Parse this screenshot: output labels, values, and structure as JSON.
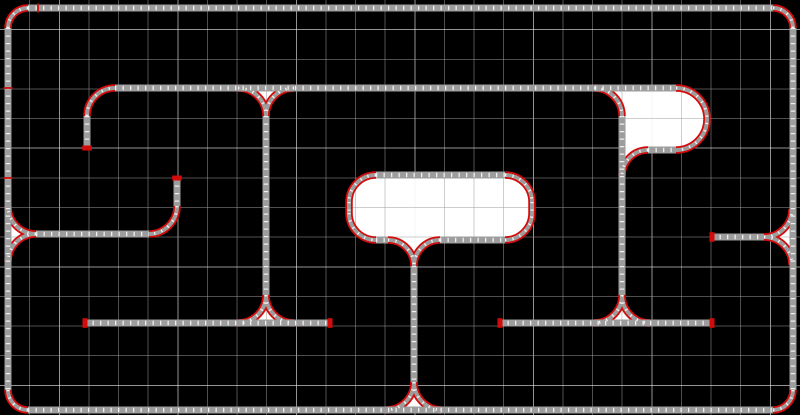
{
  "canvas": {
    "width": 800,
    "height": 415,
    "background": "#000000",
    "description": "track layout editor canvas"
  },
  "grid": {
    "cols": 27,
    "rows": 14,
    "minor_color": "rgba(158,158,158,0.5)",
    "major_color": "rgba(238,238,238,0.62)",
    "major_every": 4,
    "major_col_start": 2,
    "major_row_start": 1
  },
  "palette": {
    "track_gray": "#9d9d9d",
    "curve_red": "#d40b0b",
    "tie_white": "#f2f2f2",
    "region_fill": "#ffffff"
  },
  "regions": [
    {
      "name": "center-loop-area",
      "d": "M376,175 H505 A27,27 0 0 1 532,202 V213 A27,27 0 0 1 505,240 H440 A26,26 0 0 0 414,266 A26,26 0 0 0 388,240 H376 A27,27 0 0 1 349,213 V202 A27,27 0 0 1 376,175 Z"
    },
    {
      "name": "right-ploop-area",
      "d": "M594,88 H676 A31,31 0 1 1 676,150 H648 A26,26 0 0 0 622,176 V116 A28,28 0 0 0 594,88 Z"
    },
    {
      "name": "wye1-triangle",
      "d": "M238,88 A28,28 0 0 1 266,116 A28,28 0 0 1 294,88 Z"
    },
    {
      "name": "wye2-triangle",
      "d": "M238,323 A28,28 0 0 0 266,295 A28,28 0 0 0 294,323 Z"
    },
    {
      "name": "wye3-triangle",
      "d": "M8,206 A28,28 0 0 0 36,234 A28,28 0 0 0 8,262 Z"
    },
    {
      "name": "wye4-triangle",
      "d": "M792,209 A28,28 0 0 1 764,237 A28,28 0 0 1 792,265 Z"
    },
    {
      "name": "wye5-triangle",
      "d": "M386,410 A28,28 0 0 0 414,382 A28,28 0 0 0 442,410 Z"
    },
    {
      "name": "wye6-triangle",
      "d": "M594,323 A28,28 0 0 0 622,295 A28,28 0 0 0 650,323 Z"
    }
  ],
  "tracks": [
    {
      "name": "outer-top",
      "kind": "straight",
      "d": "M28,8 H773"
    },
    {
      "name": "outer-bottom",
      "kind": "straight",
      "d": "M28,410 H773"
    },
    {
      "name": "outer-left",
      "kind": "straight",
      "d": "M8,28 V390"
    },
    {
      "name": "outer-right",
      "kind": "straight",
      "d": "M793,28 V390"
    },
    {
      "name": "corner-top-left",
      "kind": "curve",
      "d": "M28,8 A20,20 0 0 0 8,28"
    },
    {
      "name": "corner-top-right",
      "kind": "curve",
      "d": "M773,8 A20,20 0 0 1 793,28"
    },
    {
      "name": "corner-bottom-left",
      "kind": "curve",
      "d": "M8,390 A20,20 0 0 0 28,410"
    },
    {
      "name": "corner-bottom-right",
      "kind": "curve",
      "d": "M773,410 A20,20 0 0 0 793,390"
    },
    {
      "name": "main-horizontal",
      "kind": "straight",
      "d": "M115,88 H676"
    },
    {
      "name": "spur-a-curve",
      "kind": "curve",
      "d": "M87,116 A28,28 0 0 1 115,88"
    },
    {
      "name": "spur-a-stub",
      "kind": "straight",
      "d": "M87,116 V148"
    },
    {
      "name": "wye1-west-arc",
      "kind": "curve",
      "d": "M238,88 A28,28 0 0 1 266,116"
    },
    {
      "name": "wye1-east-arc",
      "kind": "curve",
      "d": "M294,88 A28,28 0 0 0 266,116"
    },
    {
      "name": "center-vertical",
      "kind": "straight",
      "d": "M266,116 V295"
    },
    {
      "name": "wye2-west-arc",
      "kind": "curve",
      "d": "M266,295 A28,28 0 0 1 238,323"
    },
    {
      "name": "wye2-east-arc",
      "kind": "curve",
      "d": "M266,295 A28,28 0 0 0 294,323"
    },
    {
      "name": "siding-left",
      "kind": "straight",
      "d": "M85,323 H330"
    },
    {
      "name": "spur-b-stub",
      "kind": "straight",
      "d": "M177,178 V206"
    },
    {
      "name": "spur-b-curve",
      "kind": "curve",
      "d": "M177,206 A28,28 0 0 1 149,234"
    },
    {
      "name": "spur-b-horizontal",
      "kind": "straight",
      "d": "M36,234 H149"
    },
    {
      "name": "wye3-north-arc",
      "kind": "curve",
      "d": "M36,234 A28,28 0 0 1 8,206"
    },
    {
      "name": "wye3-south-arc",
      "kind": "curve",
      "d": "M36,234 A28,28 0 0 0 8,262"
    },
    {
      "name": "siding-right-upper",
      "kind": "straight",
      "d": "M712,237 H764"
    },
    {
      "name": "wye4-north-arc",
      "kind": "curve",
      "d": "M764,237 A28,28 0 0 0 792,209"
    },
    {
      "name": "wye4-south-arc",
      "kind": "curve",
      "d": "M764,237 A28,28 0 0 1 792,265"
    },
    {
      "name": "blob-top",
      "kind": "straight",
      "d": "M376,175 H505"
    },
    {
      "name": "blob-corner-tl",
      "kind": "curve",
      "d": "M376,175 A27,27 0 0 0 349,202"
    },
    {
      "name": "blob-left-edge",
      "kind": "curve",
      "d": "M349,202 V213"
    },
    {
      "name": "blob-corner-bl",
      "kind": "curve",
      "d": "M349,213 A27,27 0 0 0 376,240"
    },
    {
      "name": "blob-bottom-west",
      "kind": "straight",
      "d": "M376,240 H388"
    },
    {
      "name": "funnel-west",
      "kind": "curve",
      "d": "M388,240 A26,26 0 0 1 414,266"
    },
    {
      "name": "funnel-east",
      "kind": "curve",
      "d": "M440,240 A26,26 0 0 0 414,266"
    },
    {
      "name": "blob-bottom-east",
      "kind": "straight",
      "d": "M440,240 H505"
    },
    {
      "name": "blob-corner-br",
      "kind": "curve",
      "d": "M505,240 A27,27 0 0 0 532,213"
    },
    {
      "name": "blob-right-edge",
      "kind": "curve",
      "d": "M532,202 V213"
    },
    {
      "name": "blob-corner-tr",
      "kind": "curve",
      "d": "M505,175 A27,27 0 0 1 532,202"
    },
    {
      "name": "stem-vertical",
      "kind": "straight",
      "d": "M414,266 V382"
    },
    {
      "name": "wye5-west-arc",
      "kind": "curve",
      "d": "M414,382 A28,28 0 0 1 386,410"
    },
    {
      "name": "wye5-east-arc",
      "kind": "curve",
      "d": "M414,382 A28,28 0 0 0 442,410"
    },
    {
      "name": "ploop-switch-curve",
      "kind": "curve",
      "d": "M594,88 A28,28 0 0 1 622,116"
    },
    {
      "name": "ploop-vertical",
      "kind": "straight",
      "d": "M622,116 V295"
    },
    {
      "name": "ploop-180-curve",
      "kind": "curve",
      "d": "M676,88 A31,31 0 1 1 676,150"
    },
    {
      "name": "ploop-bottom",
      "kind": "straight",
      "d": "M648,150 H676"
    },
    {
      "name": "ploop-inner-curve",
      "kind": "curve",
      "d": "M648,150 A26,26 0 0 0 622,176"
    },
    {
      "name": "wye6-west-arc",
      "kind": "curve",
      "d": "M622,295 A28,28 0 0 1 594,323"
    },
    {
      "name": "wye6-east-arc",
      "kind": "curve",
      "d": "M622,295 A28,28 0 0 0 650,323"
    },
    {
      "name": "siding-right-lower",
      "kind": "straight",
      "d": "M500,323 H712"
    }
  ],
  "end_caps": [
    {
      "x": 87,
      "y": 148,
      "orient": "h"
    },
    {
      "x": 177,
      "y": 178,
      "orient": "h"
    },
    {
      "x": 85,
      "y": 323,
      "orient": "v"
    },
    {
      "x": 330,
      "y": 323,
      "orient": "v"
    },
    {
      "x": 500,
      "y": 323,
      "orient": "v"
    },
    {
      "x": 712,
      "y": 323,
      "orient": "v"
    },
    {
      "x": 712,
      "y": 237,
      "orient": "v"
    }
  ],
  "rail_joints": [
    {
      "x": 38,
      "y": 8,
      "orient": "v"
    },
    {
      "x": 8,
      "y": 88,
      "orient": "h"
    },
    {
      "x": 8,
      "y": 178,
      "orient": "h"
    }
  ]
}
